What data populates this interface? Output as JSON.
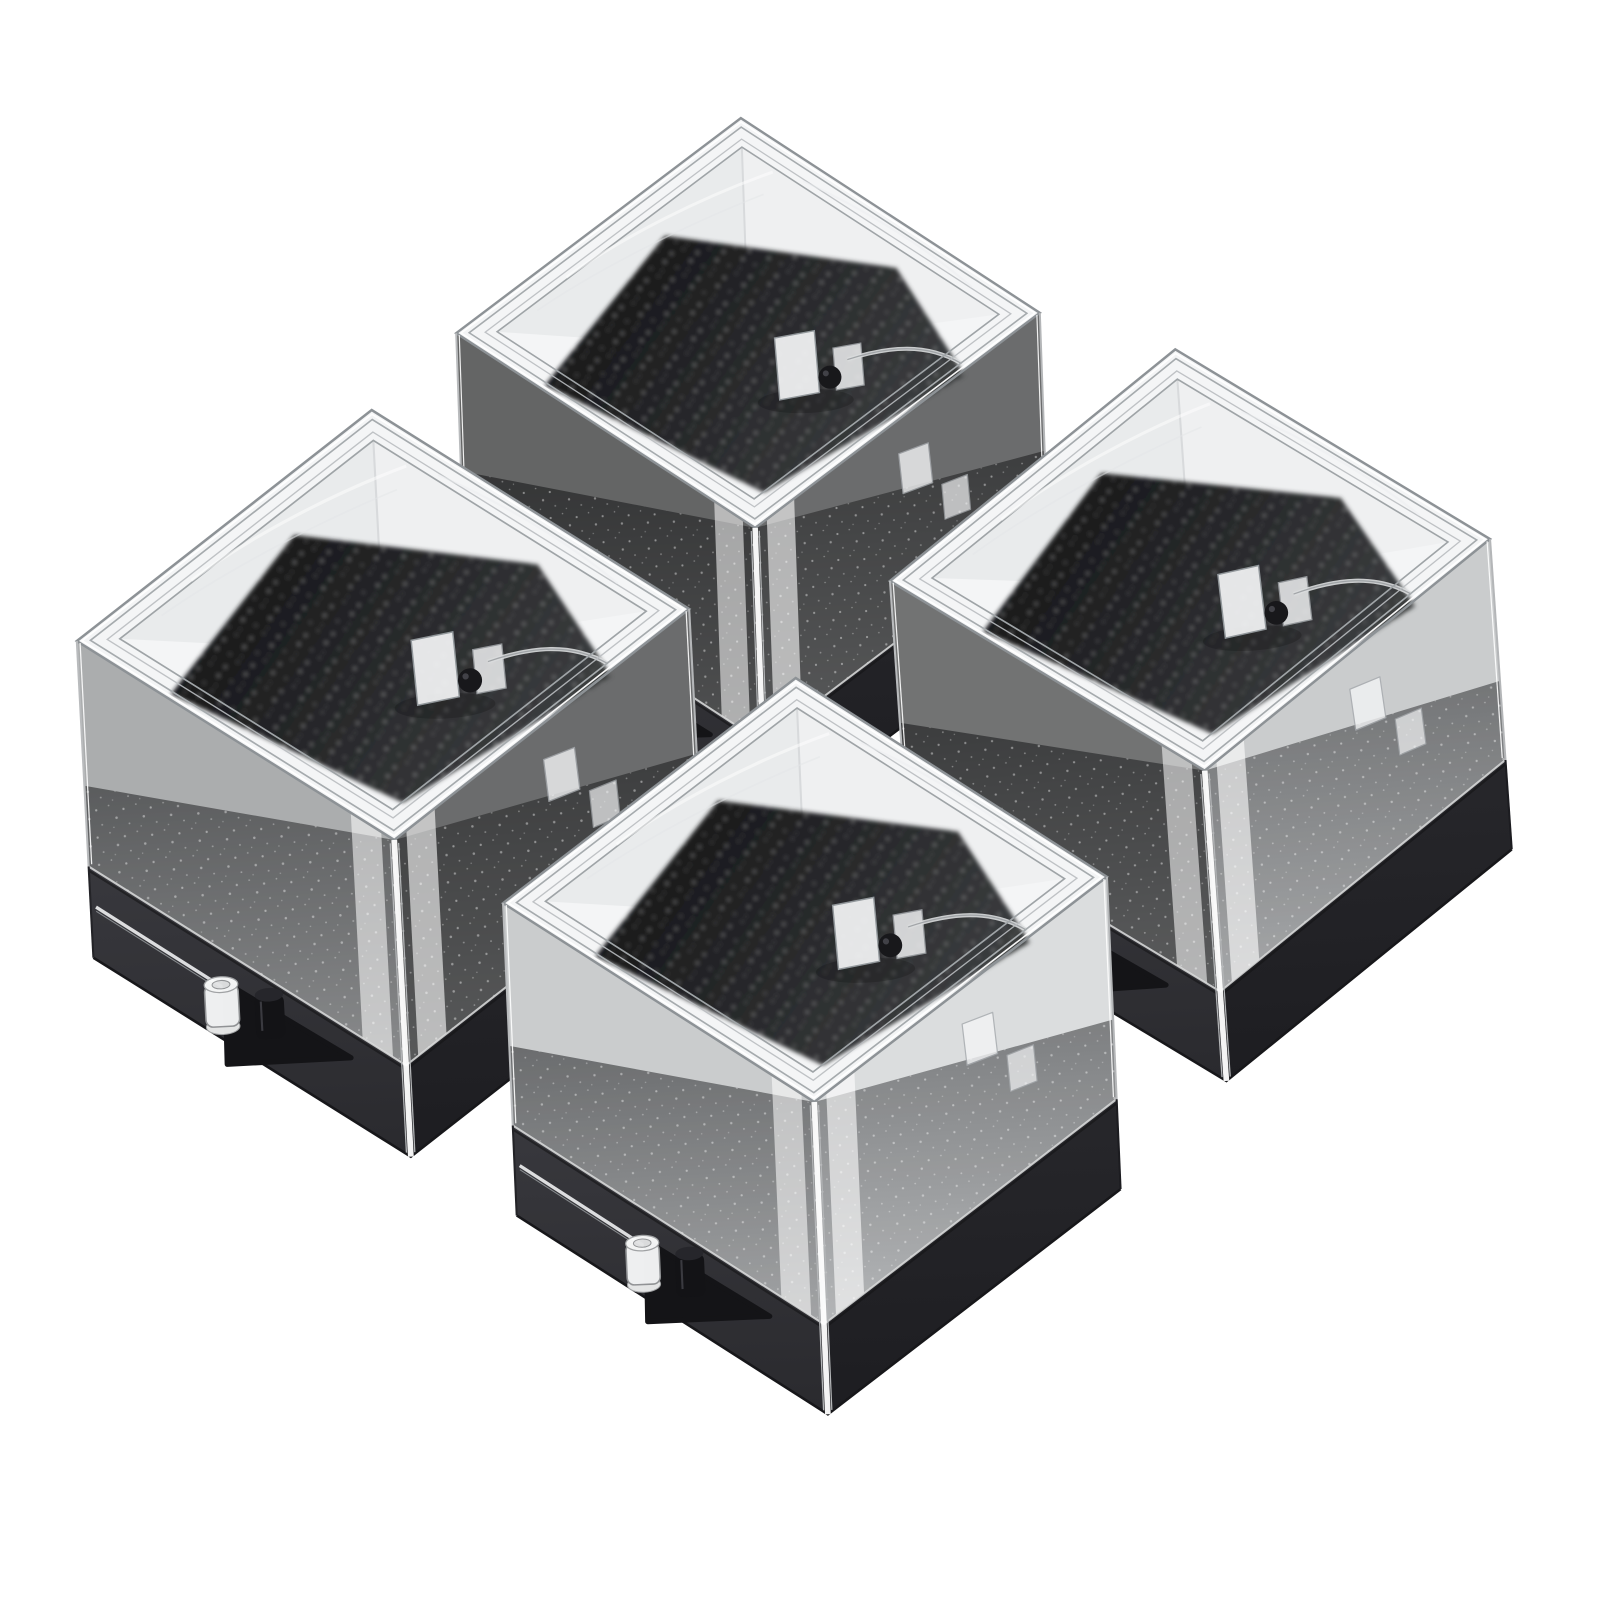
{
  "scene": {
    "subject": "Product photo: four clear square acrylic specimen display boxes with black bases and black glitter foam inserts, arranged in a two-by-two diamond on a plain white background",
    "background_color": "#ffffff",
    "object_count": 4,
    "palette": {
      "background": "#ffffff",
      "edge_line": "#8d9296",
      "edge_highlight": "#ffffff",
      "rim_line": "#a6abae",
      "top_face": "#f4f5f6",
      "inner_wall_left": "#e8eaeb",
      "inner_wall_right": "#eef0f1",
      "foam_top_dark_a": "#161618",
      "foam_top_dark_b": "#3a3c3e",
      "wall_foam_a": "#707274",
      "wall_foam_b": "#c2c4c6",
      "base_dark_a": "#38383d",
      "base_dark_b": "#1d1d21",
      "clasp_flap": "#141417",
      "peg_clear": "#f6f7f8",
      "peg_black": "#131316",
      "hinge_ball": "#18181b",
      "sparkle": "#ffffff"
    },
    "boxes": [
      {
        "id": "back",
        "position": "top rear",
        "cx": 748,
        "cy": 323,
        "scale": 1.0,
        "rotate": -2,
        "wall_shade_left": 0.58,
        "wall_shade_right": 0.55
      },
      {
        "id": "right",
        "position": "right",
        "cx": 1190,
        "cy": 560,
        "scale": 1.03,
        "rotate": -4,
        "wall_shade_left": 0.52,
        "wall_shade_right": 0.15
      },
      {
        "id": "left",
        "position": "left",
        "cx": 383,
        "cy": 625,
        "scale": 1.05,
        "rotate": -3,
        "wall_shade_left": 0.28,
        "wall_shade_right": 0.55
      },
      {
        "id": "front",
        "position": "front",
        "cx": 805,
        "cy": 890,
        "scale": 1.035,
        "rotate": -2.5,
        "wall_shade_left": 0.15,
        "wall_shade_right": 0.08
      }
    ],
    "box_features": {
      "lid": "clear acrylic cube cover with stepped rim",
      "insert": "black glitter foam pad",
      "base": "black plastic tray",
      "hinge": "clear hinge tabs with black pivot ball at rear",
      "clasp": "front latch flap with one clear peg and one black peg"
    }
  }
}
